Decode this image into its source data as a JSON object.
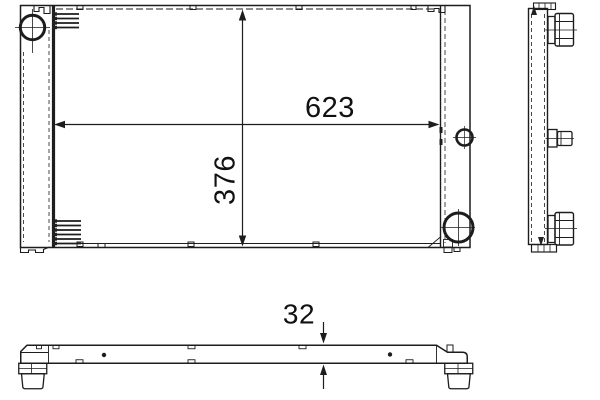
{
  "colors": {
    "background": "#ffffff",
    "line": "#1d1d1d",
    "text": "#111111"
  },
  "dimensions": {
    "width": "623",
    "height": "376",
    "depth": "32"
  }
}
